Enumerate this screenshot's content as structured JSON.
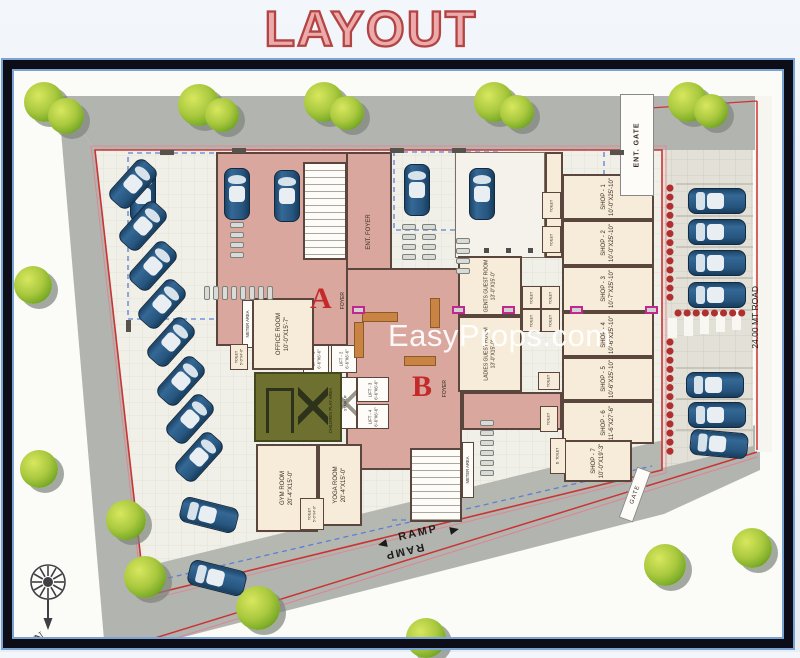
{
  "title": "LAYOUT",
  "watermark": "EasyProps.com",
  "compass": {
    "north": "N"
  },
  "roads": {
    "right_road": "24.00 MT ROAD",
    "ent_gate": "ENT. GATE",
    "gate": "GATE",
    "ramp": "RAMP"
  },
  "building": {
    "wing_a": {
      "letter": "A",
      "foyer_label": "FOYER"
    },
    "wing_b": {
      "letter": "B",
      "foyer_label": "FOYER"
    },
    "ent_foyer_label": "ENT. FOYER",
    "stair_label": "STAIR UP",
    "meter_area_label": "METER AREA",
    "rooms": {
      "office": {
        "name": "OFFICE ROOM",
        "size": "10'-0\"X15'-7\""
      },
      "gym": {
        "name": "GYM ROOM",
        "size": "20'-4\"X15'-0\""
      },
      "yoga": {
        "name": "YOGA ROOM",
        "size": "20'-4\"X15'-0\""
      },
      "children_play": {
        "name": "CHILDREN PLAY AREA"
      },
      "gents_guest": {
        "name": "GENTS GUEST ROOM",
        "size": "13'-0\"X15'-0\""
      },
      "ladies_guest": {
        "name": "LADIES GUEST ROOM",
        "size": "13'-0\"X15'-0\""
      },
      "toilet": {
        "name": "TOILET",
        "size": "5'-0\"X4'-0\""
      },
      "d_toilet": {
        "name": "D. TOILET"
      }
    },
    "lifts": [
      {
        "name": "LIFT - 1",
        "size": "6'-6\"X6'-6\""
      },
      {
        "name": "LIFT - 2",
        "size": "6'-6\"X6'-6\""
      },
      {
        "name": "LIFT - 3",
        "size": "6'-6\"X6'-6\""
      },
      {
        "name": "LIFT - 4",
        "size": "6'-6\"X6'-6\""
      }
    ],
    "shops": [
      {
        "name": "SHOP - 1",
        "size": "10'-0\"X25'-10\""
      },
      {
        "name": "SHOP - 2",
        "size": "10'-0\"X25'-10\""
      },
      {
        "name": "SHOP - 3",
        "size": "10'-7\"X25'-10\""
      },
      {
        "name": "SHOP - 4",
        "size": "10'-6\"X25'-10\""
      },
      {
        "name": "SHOP - 5",
        "size": "10'-6\"X25'-10\""
      },
      {
        "name": "SHOP - 6",
        "size": "11'-6\"X27'-6\""
      },
      {
        "name": "SHOP - 7",
        "size": "10'-0\"X19'-3\""
      }
    ]
  },
  "colors": {
    "title_fill": "#ecaaaa",
    "title_stroke": "#b34444",
    "boundary_red": "#cc3333",
    "foyer_pink": "#d9a79e",
    "room_beige": "#f6ecd9",
    "play_olive": "#6e7030",
    "car_blue": "#27567f"
  }
}
